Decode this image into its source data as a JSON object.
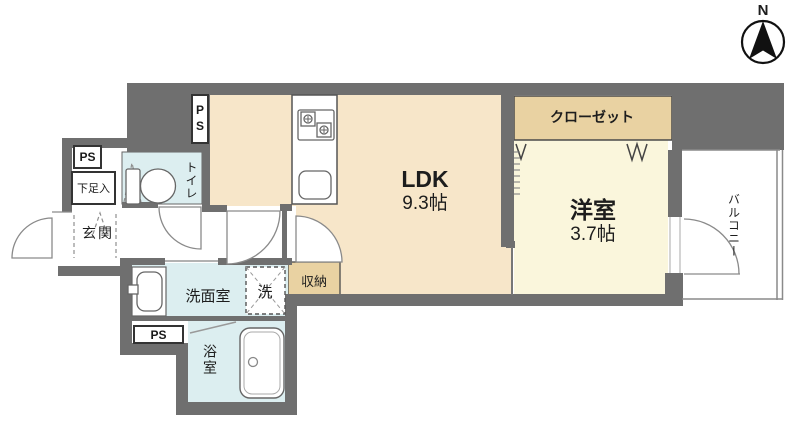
{
  "compass": {
    "north_label": "N"
  },
  "rooms": {
    "ldk": {
      "label": "LDK",
      "area": "9.3帖"
    },
    "western": {
      "label": "洋室",
      "area": "3.7帖"
    },
    "closet": {
      "label": "クローゼット"
    },
    "balcony": {
      "label": "バルコニー"
    },
    "genkan": {
      "label": "玄関"
    },
    "shoe_cabinet": {
      "label": "下足入"
    },
    "toilet": {
      "label": "トイレ"
    },
    "washroom": {
      "label": "洗面室"
    },
    "washer_space": {
      "label": "洗"
    },
    "storage": {
      "label": "収納"
    },
    "bathroom": {
      "label": "浴室"
    }
  },
  "pipe_spaces": {
    "top": "PS",
    "left": "PS",
    "bottom": "PS"
  },
  "colors": {
    "wall": "#6f6f6f",
    "ldk_floor": "#f7e6c9",
    "western_floor": "#faf6dc",
    "closet_floor": "#e9d2a2",
    "wet_floor": "#dceef0",
    "balcony_floor": "#ffffff"
  }
}
